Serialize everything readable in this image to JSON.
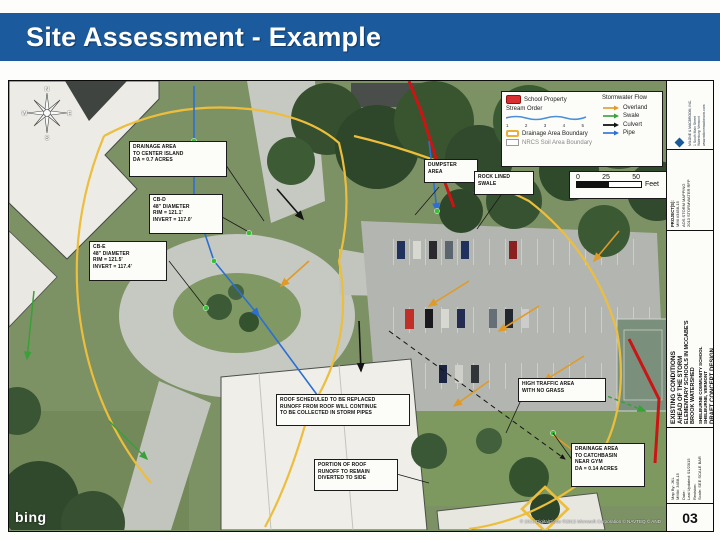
{
  "slide": {
    "title": "Site Assessment - Example",
    "title_bar_color": "#1b5b9d"
  },
  "map": {
    "attribution": {
      "logo": "bing",
      "copyright": "© 2013 DigitalGlobe ©2013 Microsoft Corporation © NAVTEQ © AND"
    },
    "compass": {
      "n": "N",
      "e": "E",
      "s": "S",
      "w": "W"
    },
    "legend": {
      "school_property": "School Property",
      "stream_order_label": "Stream Order",
      "stream_order": [
        "1",
        "2",
        "3",
        "4",
        "5"
      ],
      "drainage_boundary": "Drainage Area Boundary",
      "nrcs_boundary": "NRCS Soil Area Boundary",
      "flow_header": "Stormwater Flow",
      "flow_items": [
        {
          "label": "Overland",
          "color": "#e09a28"
        },
        {
          "label": "Swale",
          "color": "#3aa03a"
        },
        {
          "label": "Culvert",
          "color": "#141414"
        },
        {
          "label": "Pipe",
          "color": "#2b6fd4"
        }
      ]
    },
    "scale_bar": {
      "ticks": [
        "0",
        "25",
        "50"
      ],
      "unit": "Feet"
    },
    "callouts": {
      "drainage_center_island": "DRAINAGE AREA\nTO CENTER ISLAND\nDA = 0.7 ACRES",
      "cb_d": "CB-D\n48\" DIAMETER\nRIM = 121.1'\nINVERT = 117.0'",
      "cb_e": "CB-E\n48\" DIAMETER\nRIM = 121.5'\nINVERT = 117.4'",
      "dumpster": "DUMPSTER\nAREA",
      "rock_lined_swale": "ROCK LINED\nSWALE",
      "roof_replaced": "ROOF SCHEDULED TO BE REPLACED\nRUNOFF FROM ROOF WILL CONTINUE\nTO BE COLLECTED IN STORM PIPES",
      "roof_portion": "PORTION OF ROOF\nRUNOFF TO REMAIN\nDIVERTED TO SIDE",
      "high_traffic": "HIGH TRAFFIC AREA\nWITH NO GRASS",
      "drainage_gym": "DRAINAGE AREA\nTO CATCHBASIN\nNEAR GYM\nDA = 0.14 ACRES"
    }
  },
  "titleblock": {
    "firm_lines": "MILONE & MACBROOM, INC.\n1 South Main Street\nWaterbury, Vermont\nwww.milonemacbroom.com",
    "project_label": "PROJECT(S):",
    "project_lines": "MMI #3458-15\nAOS STORM MAPPING\n2013 STORMWATER RFP",
    "existing_conditions": "EXISTING CONDITIONS",
    "subtitle1": "AHEAD OF THE STORM",
    "subtitle2": "ELEMENTARY SCHOOLS IN MCCABE'S\nBROOK WATERSHED",
    "subtitle3": "SHELBURNE COMMUNITY SCHOOL\nSHELBURNE, VERMONT",
    "draft": "DRAFT CONCEPT DESIGN",
    "fields": "Map By: JKL\nMMI#: 3458-15\nDate:\nLast Updated: 01/23/15\nRevision:\nScale: SEE SCALE BAR",
    "sheet_number": "03"
  }
}
